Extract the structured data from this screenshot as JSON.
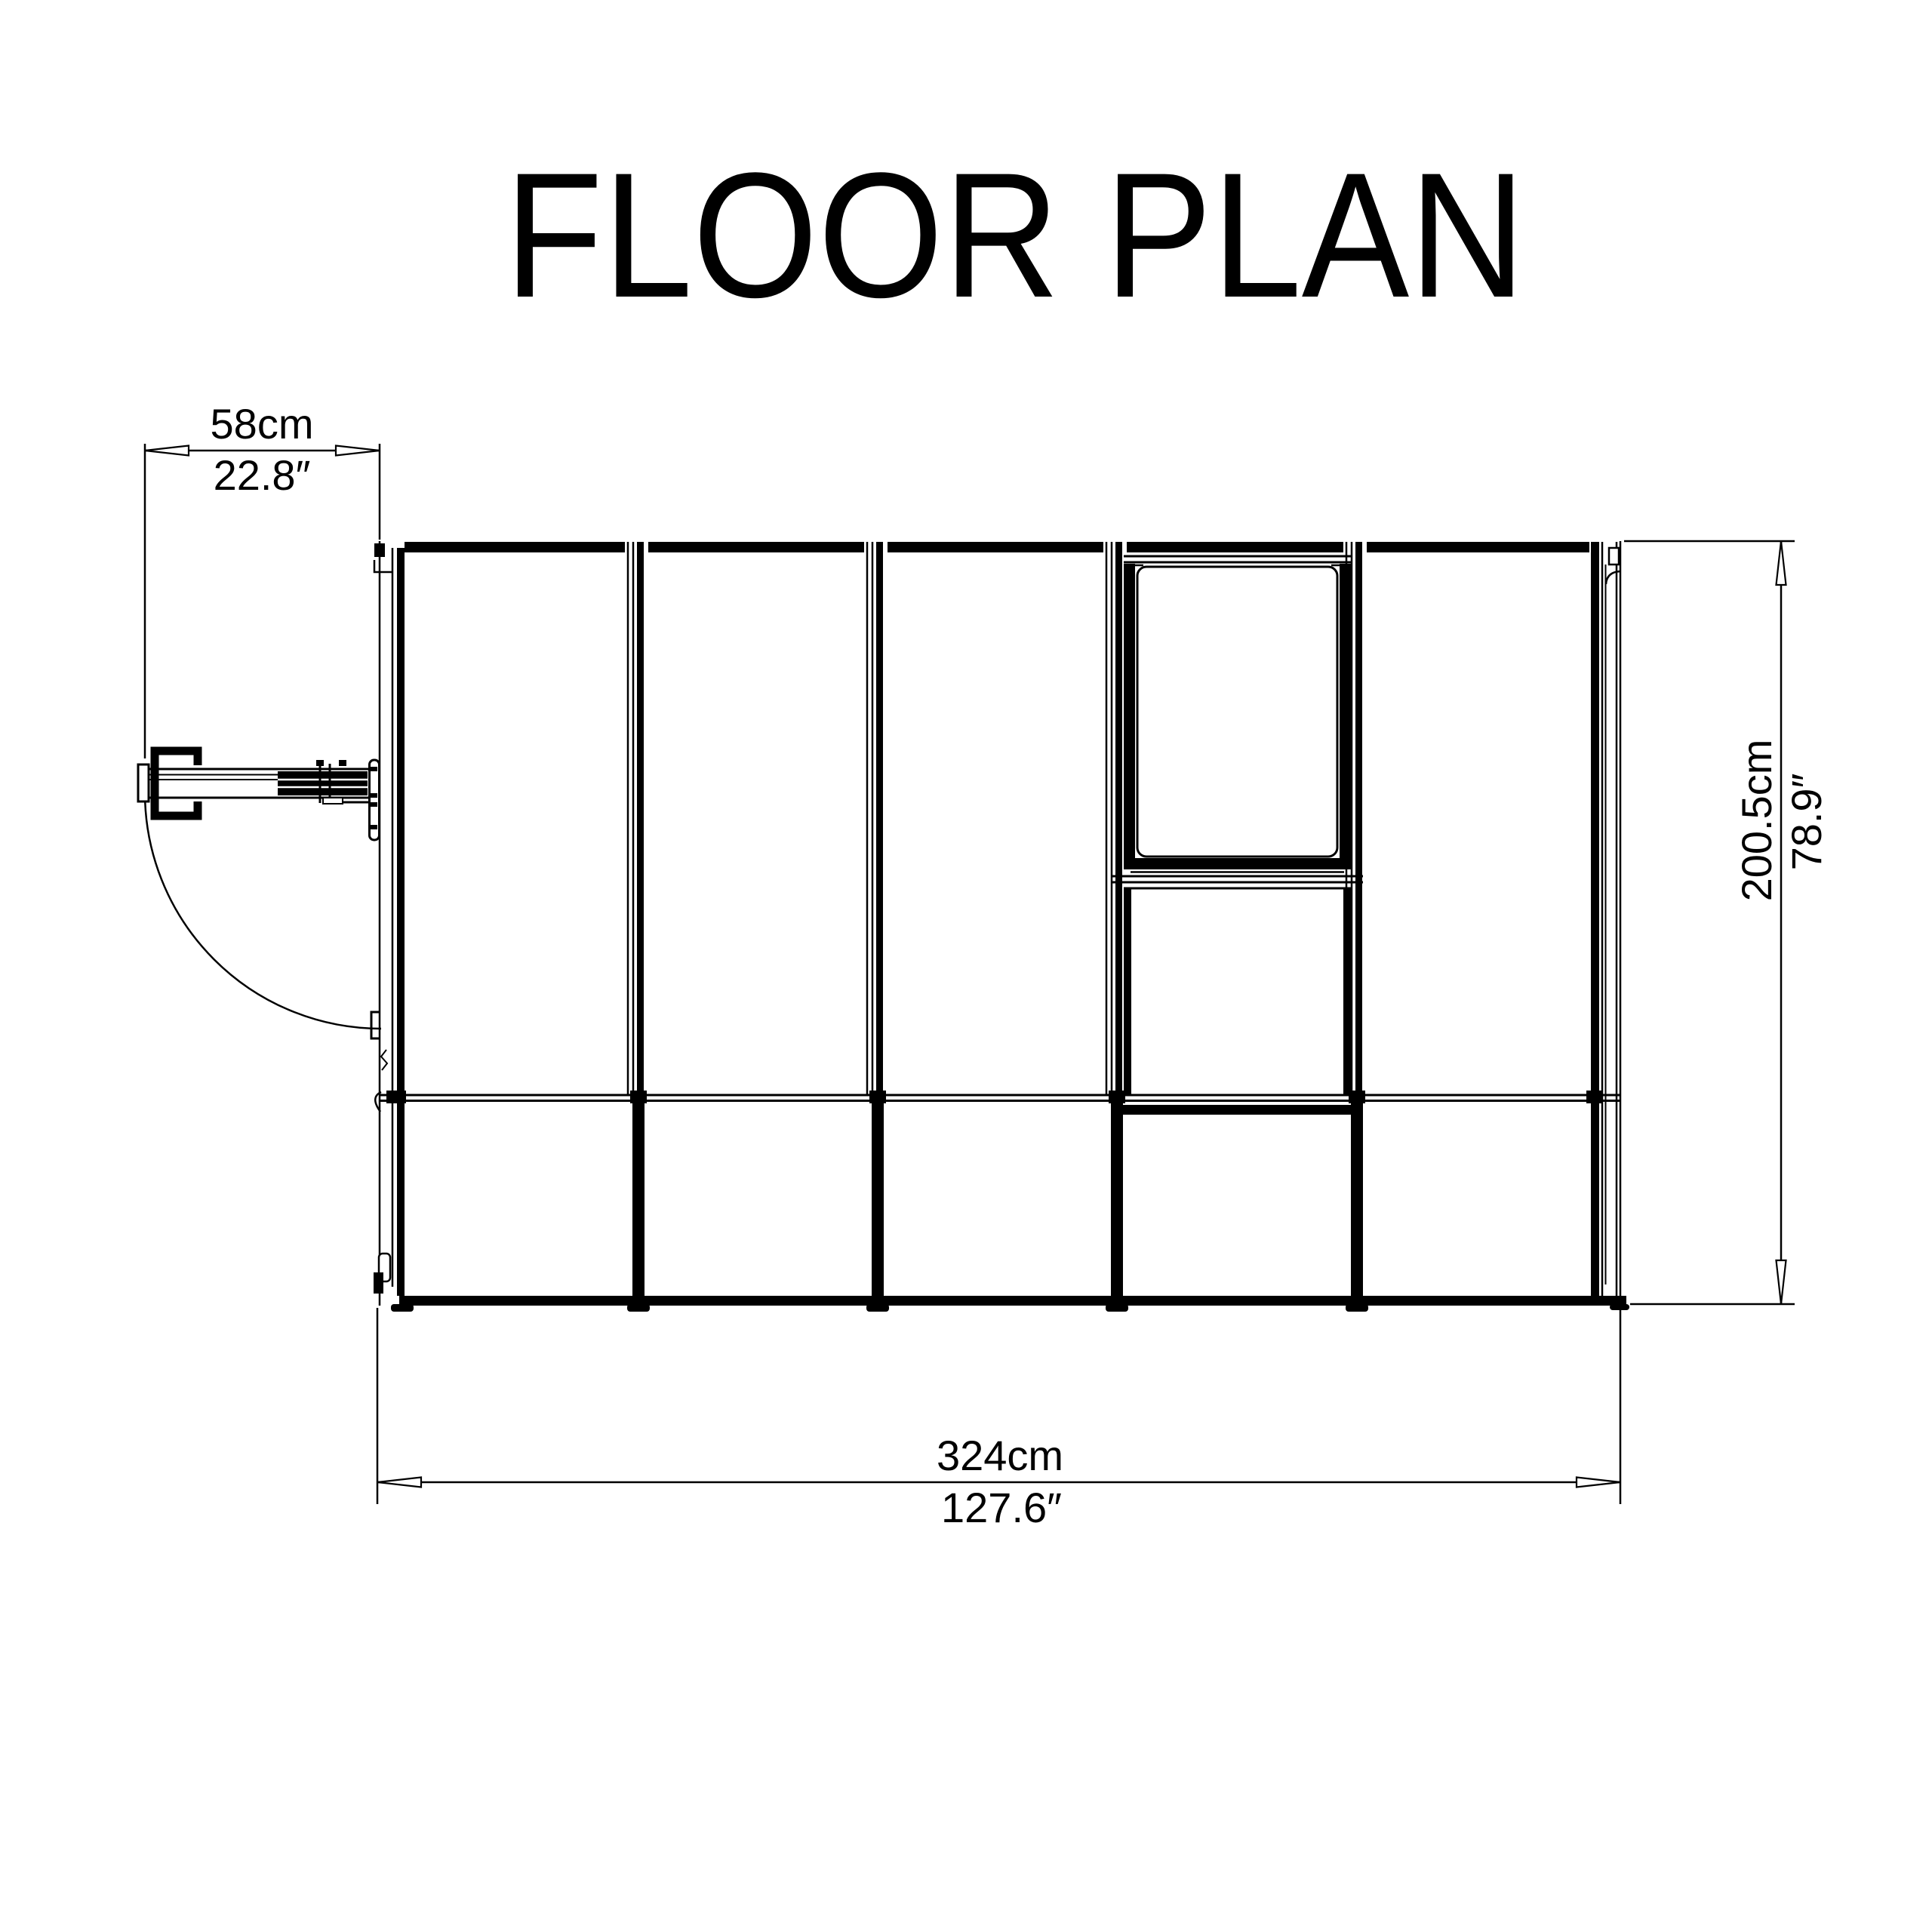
{
  "title": "FLOOR PLAN",
  "colors": {
    "line": "#000000",
    "background": "#ffffff"
  },
  "floor_plan": {
    "door_dimension": {
      "metric": "58cm",
      "imperial": "22.8″"
    },
    "length_dimension": {
      "metric": "324cm",
      "imperial": "127.6″"
    },
    "width_dimension": {
      "metric": "200.5cm",
      "imperial": "78.9″"
    }
  }
}
